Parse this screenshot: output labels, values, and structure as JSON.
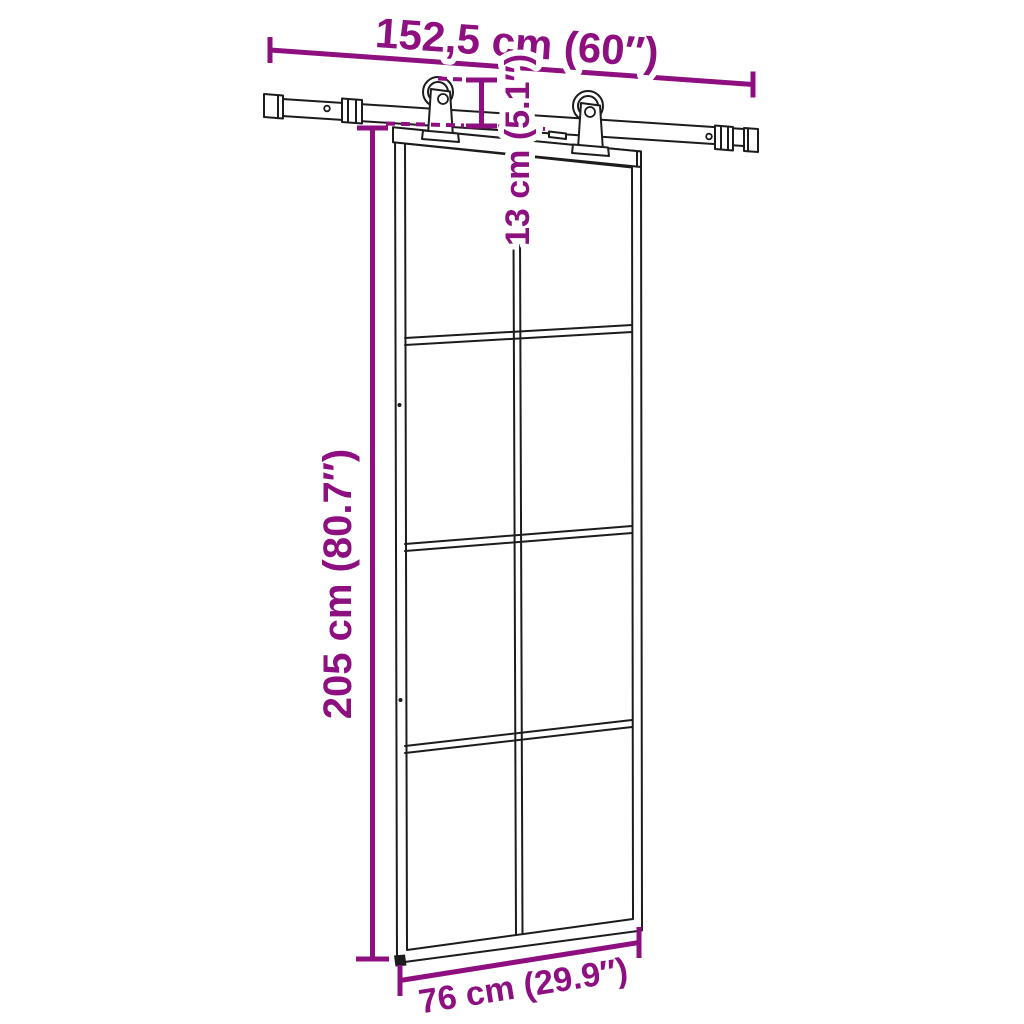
{
  "diagram": {
    "type": "product-dimension-diagram",
    "product": "sliding barn door with glass panes and top-mount sliding rail hardware",
    "door": {
      "pane_columns": 2,
      "pane_rows": 4,
      "pane_count": 8
    },
    "hardware": {
      "roller_hangers": 2,
      "rail": "round-hole rail with end caps and connectors"
    },
    "style": {
      "accent_color": "#8e1080",
      "line_color": "#1c1c1c",
      "background_color": "#ffffff"
    },
    "dimensions": {
      "rail_length": "152,5 cm (60″)",
      "drop": "13 cm (5.1″)",
      "door_height": "205 cm (80.7″)",
      "door_width": "76 cm (29.9″)"
    }
  }
}
